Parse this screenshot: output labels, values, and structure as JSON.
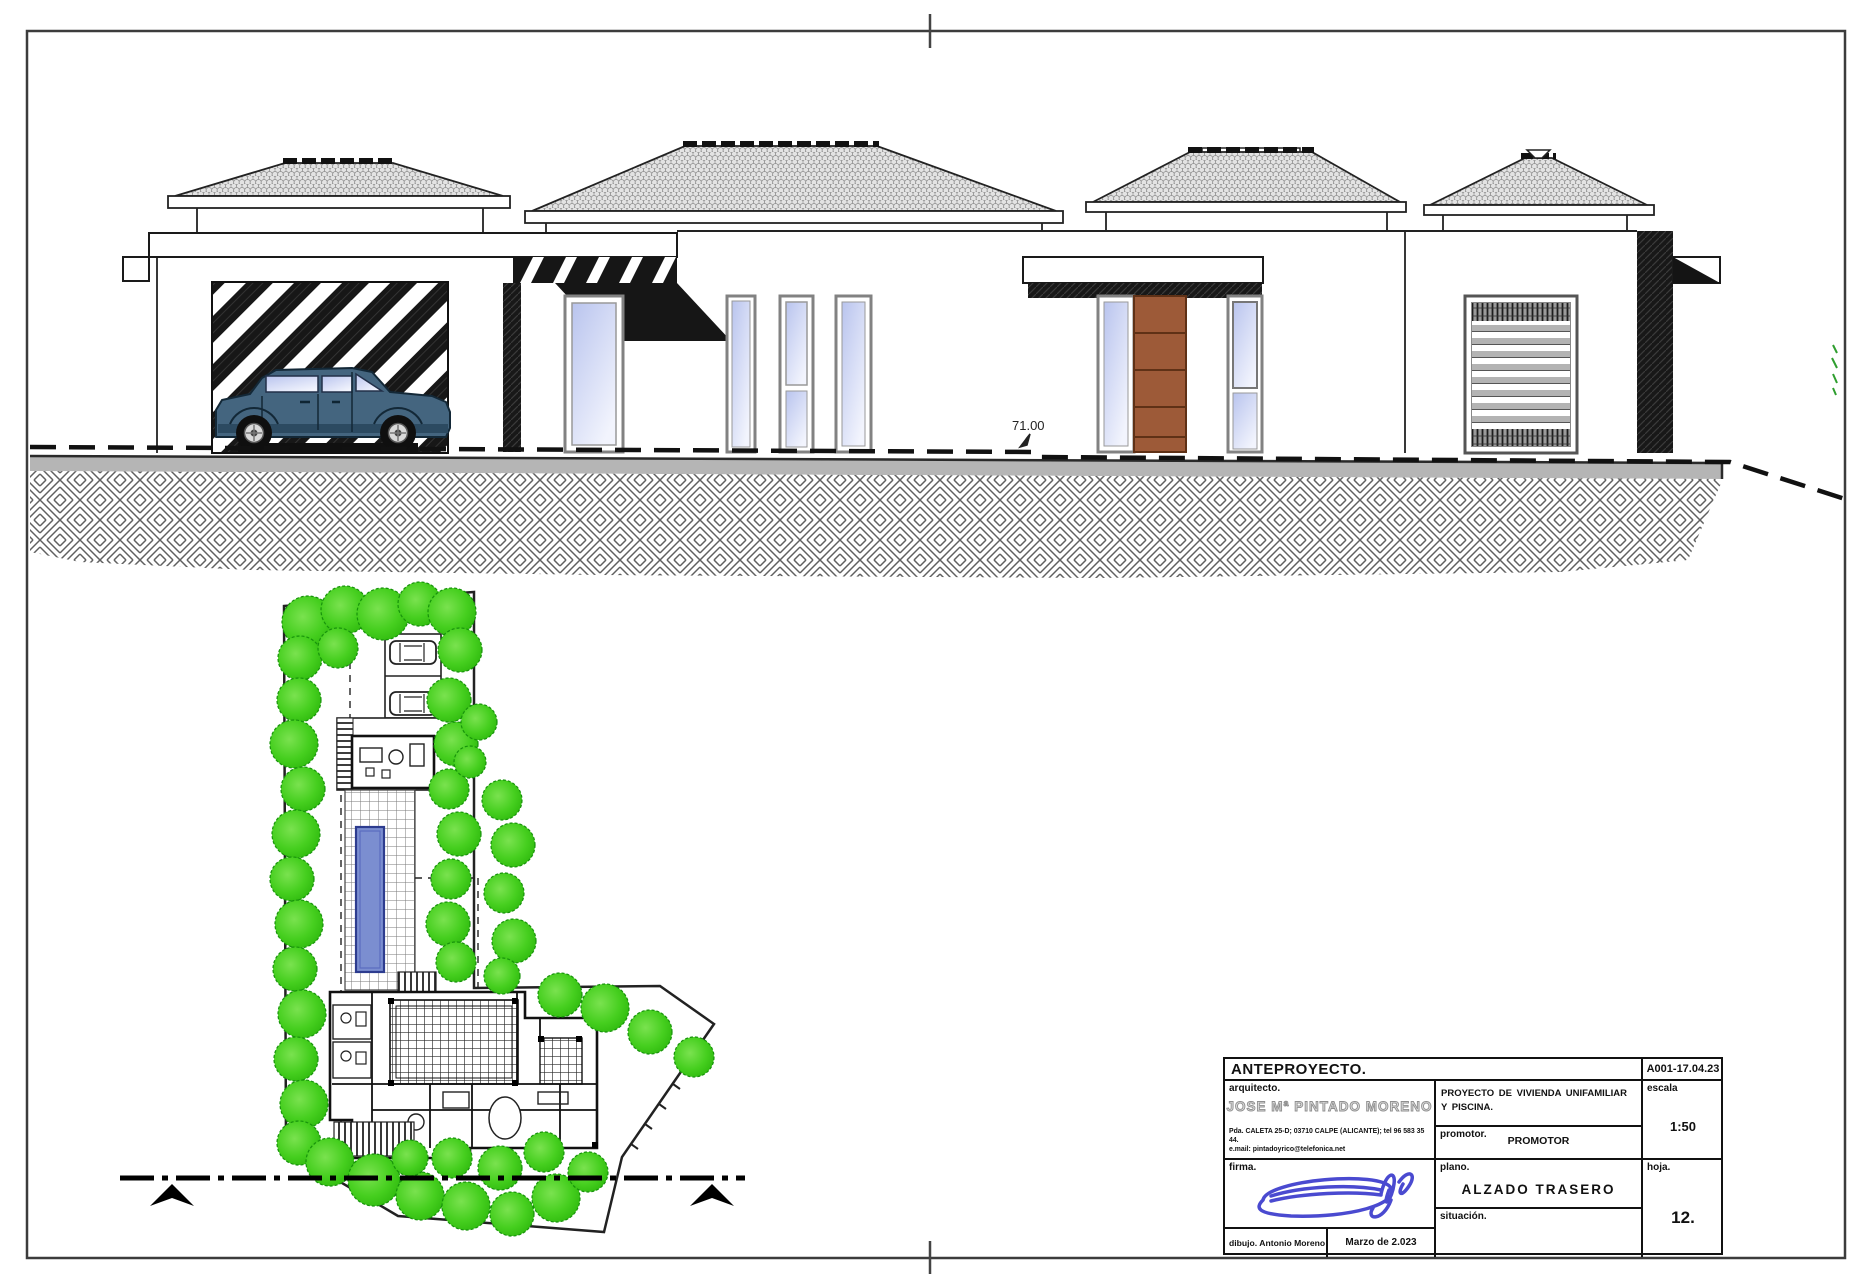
{
  "elevation": {
    "level_label": "71.00"
  },
  "title_block": {
    "phase": "ANTEPROYECTO.",
    "code": "A001-17.04.23",
    "architect_label": "arquitecto.",
    "architect_name": "JOSE Mª PINTADO MORENO",
    "architect_address": "Pda. CALETA 25-D; 03710 CALPE (ALICANTE); tel 96 583 35 44.",
    "architect_email": "e.mail: pintadoyrico@telefonica.net",
    "project_title": "PROYECTO DE VIVIENDA UNIFAMILIAR Y PISCINA.",
    "promoter_label": "promotor.",
    "promoter_value": "PROMOTOR",
    "scale_label": "escala",
    "scale_value": "1:50",
    "signature_label": "firma.",
    "plan_label": "plano.",
    "plan_value": "ALZADO TRASERO",
    "location_label": "situación.",
    "sheet_label": "hoja.",
    "sheet_value": "12.",
    "drawn_by_label": "dibujo.",
    "drawn_by_value": "Antonio Moreno",
    "date_value": "Marzo de 2.023"
  },
  "colors": {
    "tree_green": "#3cc916",
    "pool_blue": "#7b8ed0",
    "door_brown": "#9d5a38",
    "car_body": "#44657f",
    "signature_blue": "#4a4ad0",
    "road_gray": "#b5b5b5"
  }
}
